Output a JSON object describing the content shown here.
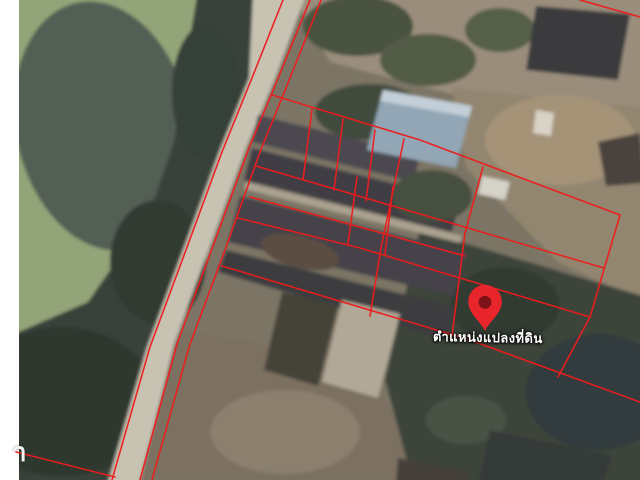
{
  "canvas": {
    "width": 640,
    "height": 480
  },
  "labels": {
    "parcel_location": "ตำแหน่งแปลงที่ดิน",
    "watermark_fragment": "า"
  },
  "colors": {
    "boundary_red": "#ee1c1c",
    "pin_red": "#e8252b",
    "pin_hole": "#7e1216",
    "label_text": "#ffffff",
    "edge_strip": "#ffffff"
  },
  "pin": {
    "tip_x": 485,
    "tip_y": 331,
    "scale": 1.4,
    "label_x": 433,
    "label_y": 327,
    "watermark_x": 12,
    "watermark_y": 432
  },
  "background": {
    "shapes": [
      {
        "name": "base-ground",
        "type": "polygon",
        "fill": "#7b7465",
        "points": "-20,-20 660,-20 660,500 -20,500"
      },
      {
        "name": "dirt-yard-top",
        "type": "polygon",
        "fill": "#9a8d7c",
        "points": "290,-10 650,-10 650,115 452,94 330,62"
      },
      {
        "name": "dirt-yard-right",
        "type": "polygon",
        "fill": "#93866f",
        "points": "452,88 650,108 650,305 558,262 466,168"
      },
      {
        "name": "dirt-light-patch",
        "type": "ellipse",
        "fill": "#a59378",
        "cx": 560,
        "cy": 140,
        "rx": 75,
        "ry": 45
      },
      {
        "name": "tree-clump-top-1",
        "type": "ellipse",
        "fill": "#4a5240",
        "cx": 358,
        "cy": 26,
        "rx": 55,
        "ry": 30
      },
      {
        "name": "tree-clump-top-2",
        "type": "ellipse",
        "fill": "#525b47",
        "cx": 428,
        "cy": 60,
        "rx": 48,
        "ry": 26
      },
      {
        "name": "tree-clump-top-3",
        "type": "ellipse",
        "fill": "#555e4a",
        "cx": 500,
        "cy": 30,
        "rx": 35,
        "ry": 22
      },
      {
        "name": "field-bottom",
        "type": "polygon",
        "fill": "#7b7060",
        "points": "186,330 300,352 380,392 432,480 138,480 176,344"
      },
      {
        "name": "field-light-patch",
        "type": "ellipse",
        "fill": "#8b7f6e",
        "cx": 285,
        "cy": 432,
        "rx": 75,
        "ry": 42
      },
      {
        "name": "trees-bottom-right",
        "type": "polygon",
        "fill": "#3c443b",
        "points": "420,230 650,298 650,490 415,490 385,380"
      },
      {
        "name": "trees-br-dark-1",
        "type": "ellipse",
        "fill": "#333b33",
        "cx": 505,
        "cy": 305,
        "rx": 55,
        "ry": 38
      },
      {
        "name": "trees-br-dark-2",
        "type": "ellipse",
        "fill": "#313a3c",
        "cx": 598,
        "cy": 392,
        "rx": 72,
        "ry": 58
      },
      {
        "name": "trees-br-light",
        "type": "ellipse",
        "fill": "#4a5245",
        "cx": 466,
        "cy": 420,
        "rx": 40,
        "ry": 24
      },
      {
        "name": "pond-water",
        "type": "polygon",
        "fill": "#93a478",
        "points": "14,-10 198,-10 186,62 174,142 150,212 88,302 14,334"
      },
      {
        "name": "pond-dark-blob",
        "type": "ellipse",
        "fill": "#525e54",
        "cx": 103,
        "cy": 126,
        "rx": 87,
        "ry": 126,
        "rot": -12
      },
      {
        "name": "trees-left-bank",
        "type": "polygon",
        "fill": "#39423a",
        "points": "198,-10 290,-10 250,80 222,152 186,250 150,347 112,485 14,485 14,334 88,302 150,212 174,142 186,62"
      },
      {
        "name": "trees-left-dark-1",
        "type": "ellipse",
        "fill": "#2e372f",
        "cx": 62,
        "cy": 402,
        "rx": 95,
        "ry": 75
      },
      {
        "name": "trees-left-dark-2",
        "type": "ellipse",
        "fill": "#323b33",
        "cx": 158,
        "cy": 262,
        "rx": 48,
        "ry": 62
      },
      {
        "name": "trees-left-dark-3",
        "type": "ellipse",
        "fill": "#353f37",
        "cx": 206,
        "cy": 92,
        "rx": 34,
        "ry": 68
      },
      {
        "name": "road-surface",
        "type": "polygon",
        "fill": "#c8c2b3",
        "points": "253,-5 306,-5 276,76 246,148 210,246 174,344 139,485 107,485 147,347 183,250 219,152 249,78"
      },
      {
        "name": "roof-top-right",
        "type": "polygon",
        "fill": "#3b3a3c",
        "points": "536,6 630,14 618,80 526,70"
      },
      {
        "name": "roof-right-edge",
        "type": "polygon",
        "fill": "#4a423c",
        "points": "598,142 640,133 644,183 606,186"
      },
      {
        "name": "white-truck",
        "type": "polygon",
        "fill": "#d8d3c6",
        "points": "536,110 554,113 551,136 533,133"
      },
      {
        "name": "roof-row-1",
        "type": "polygon",
        "fill": "#4c4a4f",
        "points": "258,115 420,155 414,182 252,142"
      },
      {
        "name": "roof-row-2",
        "type": "polygon",
        "fill": "#403e44",
        "points": "252,148 460,200 452,232 244,180"
      },
      {
        "name": "concrete-walkway",
        "type": "polygon",
        "fill": "#aaa291",
        "points": "246,182 462,236 460,243 244,189"
      },
      {
        "name": "roof-row-3",
        "type": "polygon",
        "fill": "#454349",
        "points": "240,196 466,252 454,296 228,242"
      },
      {
        "name": "roof-brown-patch",
        "type": "ellipse",
        "fill": "#5c4e42",
        "cx": 300,
        "cy": 252,
        "rx": 40,
        "ry": 16,
        "rot": 14
      },
      {
        "name": "roof-row-4",
        "type": "polygon",
        "fill": "#3e3c41",
        "points": "226,250 455,307 447,340 218,272"
      },
      {
        "name": "building-light-bottom",
        "type": "polygon",
        "fill": "#b2a898",
        "points": "342,300 400,314 378,398 322,382"
      },
      {
        "name": "roof-dark-bottom-c",
        "type": "polygon",
        "fill": "#454239",
        "points": "282,292 338,306 318,386 264,370"
      },
      {
        "name": "tree-canopy-center",
        "type": "ellipse",
        "fill": "#414c3c",
        "cx": 370,
        "cy": 112,
        "rx": 55,
        "ry": 28
      },
      {
        "name": "blue-metal-roof",
        "type": "polygon",
        "fill": "#92a6b5",
        "points": "383,90 472,106 456,168 367,150"
      },
      {
        "name": "blue-roof-highlight",
        "type": "polygon",
        "fill": "#c3cfd8",
        "points": "383,90 472,106 469,117 380,101"
      },
      {
        "name": "white-shed",
        "type": "polygon",
        "fill": "#d5d2c8",
        "points": "482,176 510,182 505,200 478,194"
      },
      {
        "name": "tree-clump-mid",
        "type": "ellipse",
        "fill": "#46503f",
        "cx": 432,
        "cy": 196,
        "rx": 40,
        "ry": 26
      },
      {
        "name": "roof-bottom-right-1",
        "type": "polygon",
        "fill": "#343a37",
        "points": "490,430 612,456 602,485 478,485"
      },
      {
        "name": "roof-bottom-right-2",
        "type": "polygon",
        "fill": "#44403b",
        "points": "398,458 470,472 466,485 396,485"
      }
    ]
  },
  "overlay": {
    "stroke_width": 1.6,
    "lines": [
      {
        "name": "road-left-boundary",
        "points": "283,0 252,78 222,152 186,250 150,347 112,480"
      },
      {
        "name": "road-right-boundary",
        "points": "310,0 279,76 249,148 213,246 177,344 140,480"
      },
      {
        "name": "road-strip-boundary",
        "points": "321,0 290,78 260,152 225,250 189,347 152,480"
      },
      {
        "name": "bottom-left-cross",
        "points": "16,452 115,477"
      },
      {
        "name": "top-right-corner",
        "points": "580,0 640,17"
      },
      {
        "name": "grid-top-boundary",
        "points": "272,95 420,140 620,215"
      },
      {
        "name": "grid-row-2",
        "points": "256,166 410,211 604,268"
      },
      {
        "name": "grid-row-3",
        "points": "250,197 465,256"
      },
      {
        "name": "grid-row-4",
        "points": "238,218 360,248 590,317"
      },
      {
        "name": "grid-bottom-boundary",
        "points": "222,266 470,340 640,402"
      },
      {
        "name": "lot-divider-1",
        "points": "312,109 303,180"
      },
      {
        "name": "lot-divider-2",
        "points": "343,119 334,190"
      },
      {
        "name": "lot-divider-3",
        "points": "375,130 366,201"
      },
      {
        "name": "lot-divider-4",
        "points": "357,177 348,244"
      },
      {
        "name": "lot-divider-5",
        "points": "393,187 385,254"
      },
      {
        "name": "lot-divider-long-1",
        "points": "404,139 381,248 370,316"
      },
      {
        "name": "lot-divider-long-2",
        "points": "483,167 465,233 452,336"
      },
      {
        "name": "grid-right-boundary",
        "points": "620,215 590,317 558,377"
      }
    ]
  }
}
